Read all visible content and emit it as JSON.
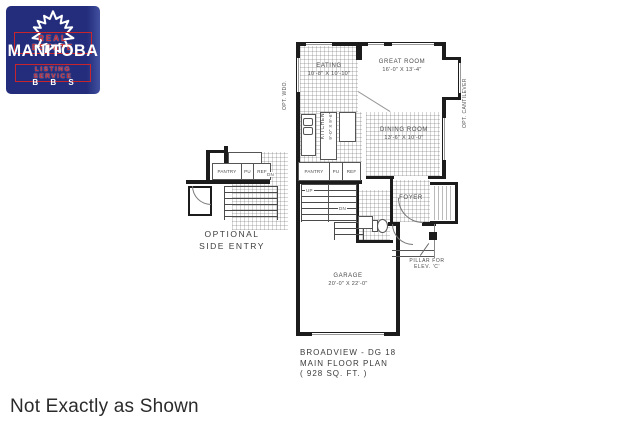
{
  "logo": {
    "real_estate": "REAL ESTATE",
    "name": "MANITOBA",
    "listing_service": "LISTING SERVICE",
    "bbs": "B B S",
    "navy_color": "#232d7b",
    "red_color": "#c8242b"
  },
  "plan": {
    "rooms": {
      "eating": {
        "name": "EATING",
        "dims": "10'-8\" X 10'-10\""
      },
      "great_room": {
        "name": "GREAT ROOM",
        "dims": "16'-0\" X 13'-4\""
      },
      "dining_room": {
        "name": "DINING ROOM",
        "dims": "13'-6\" X 10'-0\""
      },
      "kitchen": {
        "name": "KITCHEN",
        "dims": "9'-0\" X 9'-6\""
      },
      "foyer": {
        "name": "FOYER"
      },
      "garage": {
        "name": "GARAGE",
        "dims": "20'-0\" X 22'-0\""
      }
    },
    "labels": {
      "pantry": "PANTRY",
      "pu": "PU",
      "ref": "REF",
      "up": "UP",
      "dn": "DN",
      "opt_wdo": "OPT. WDO.",
      "opt_cantilever": "OPT. CANTILEVER",
      "pillar_line1": "PILLAR FOR",
      "pillar_line2": "ELEV. 'C'",
      "opt_entry_line1": "OPTIONAL",
      "opt_entry_line2": "SIDE ENTRY"
    },
    "title": {
      "line1": "BROADVIEW - DG 18",
      "line2": "MAIN FLOOR PLAN",
      "line3": "( 928 SQ. FT. )"
    },
    "wall_color": "#1c1c1c"
  },
  "footer": {
    "disclaimer": "Not Exactly as Shown"
  }
}
